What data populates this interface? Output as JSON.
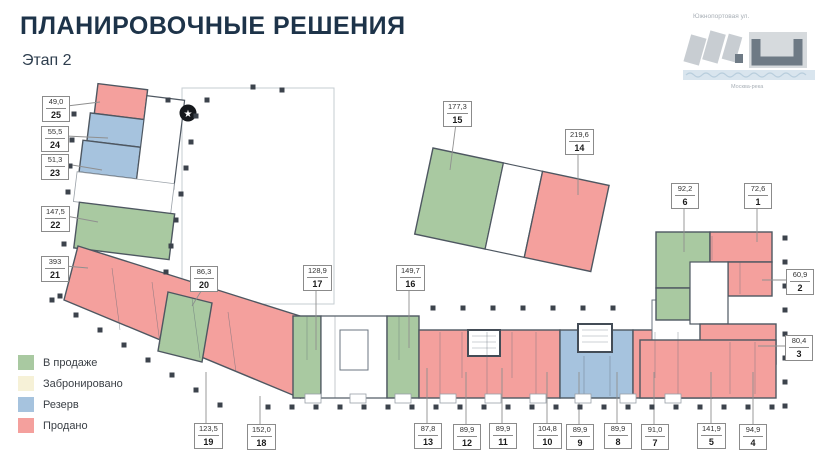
{
  "page": {
    "title": "ПЛАНИРОВОЧНЫЕ РЕШЕНИЯ",
    "stage": "Этап 2"
  },
  "minimap": {
    "street": "Южнопортовая ул.",
    "river": "Москва-река"
  },
  "legend": {
    "items": [
      {
        "label": "В продаже",
        "color": "#a9c9a1"
      },
      {
        "label": "Забронировано",
        "color": "#f6f1d7"
      },
      {
        "label": "Резерв",
        "color": "#a6c3de"
      },
      {
        "label": "Продано",
        "color": "#f4a09d"
      }
    ]
  },
  "units": [
    {
      "number": "1",
      "area": "72,6",
      "status": "Продано"
    },
    {
      "number": "2",
      "area": "60,9",
      "status": "Продано"
    },
    {
      "number": "3",
      "area": "80,4",
      "status": "Продано"
    },
    {
      "number": "4",
      "area": "94,9",
      "status": "Продано"
    },
    {
      "number": "5",
      "area": "141,9",
      "status": "Продано"
    },
    {
      "number": "6",
      "area": "92,2",
      "status": "В продаже"
    },
    {
      "number": "7",
      "area": "91,0",
      "status": "Продано"
    },
    {
      "number": "8",
      "area": "89,9",
      "status": "Резерв"
    },
    {
      "number": "9",
      "area": "89,9",
      "status": "Резерв"
    },
    {
      "number": "10",
      "area": "104,8",
      "status": "Продано"
    },
    {
      "number": "11",
      "area": "89,9",
      "status": "Продано"
    },
    {
      "number": "12",
      "area": "89,9",
      "status": "Продано"
    },
    {
      "number": "13",
      "area": "87,8",
      "status": "Продано"
    },
    {
      "number": "14",
      "area": "219,6",
      "status": "Продано"
    },
    {
      "number": "15",
      "area": "177,3",
      "status": "В продаже"
    },
    {
      "number": "16",
      "area": "149,7",
      "status": "В продаже"
    },
    {
      "number": "17",
      "area": "128,9",
      "status": "В продаже"
    },
    {
      "number": "18",
      "area": "152,0",
      "status": "Продано"
    },
    {
      "number": "19",
      "area": "123,5",
      "status": "Продано"
    },
    {
      "number": "20",
      "area": "86,3",
      "status": "В продаже"
    },
    {
      "number": "21",
      "area": "393",
      "status": "Продано"
    },
    {
      "number": "22",
      "area": "147,5",
      "status": "В продаже"
    },
    {
      "number": "23",
      "area": "51,3",
      "status": "Резерв"
    },
    {
      "number": "24",
      "area": "55,5",
      "status": "Резерв"
    },
    {
      "number": "25",
      "area": "49,0",
      "status": "Продано"
    }
  ],
  "colors": {
    "wall": "#4e5761",
    "accent_title": "#1d3349"
  }
}
